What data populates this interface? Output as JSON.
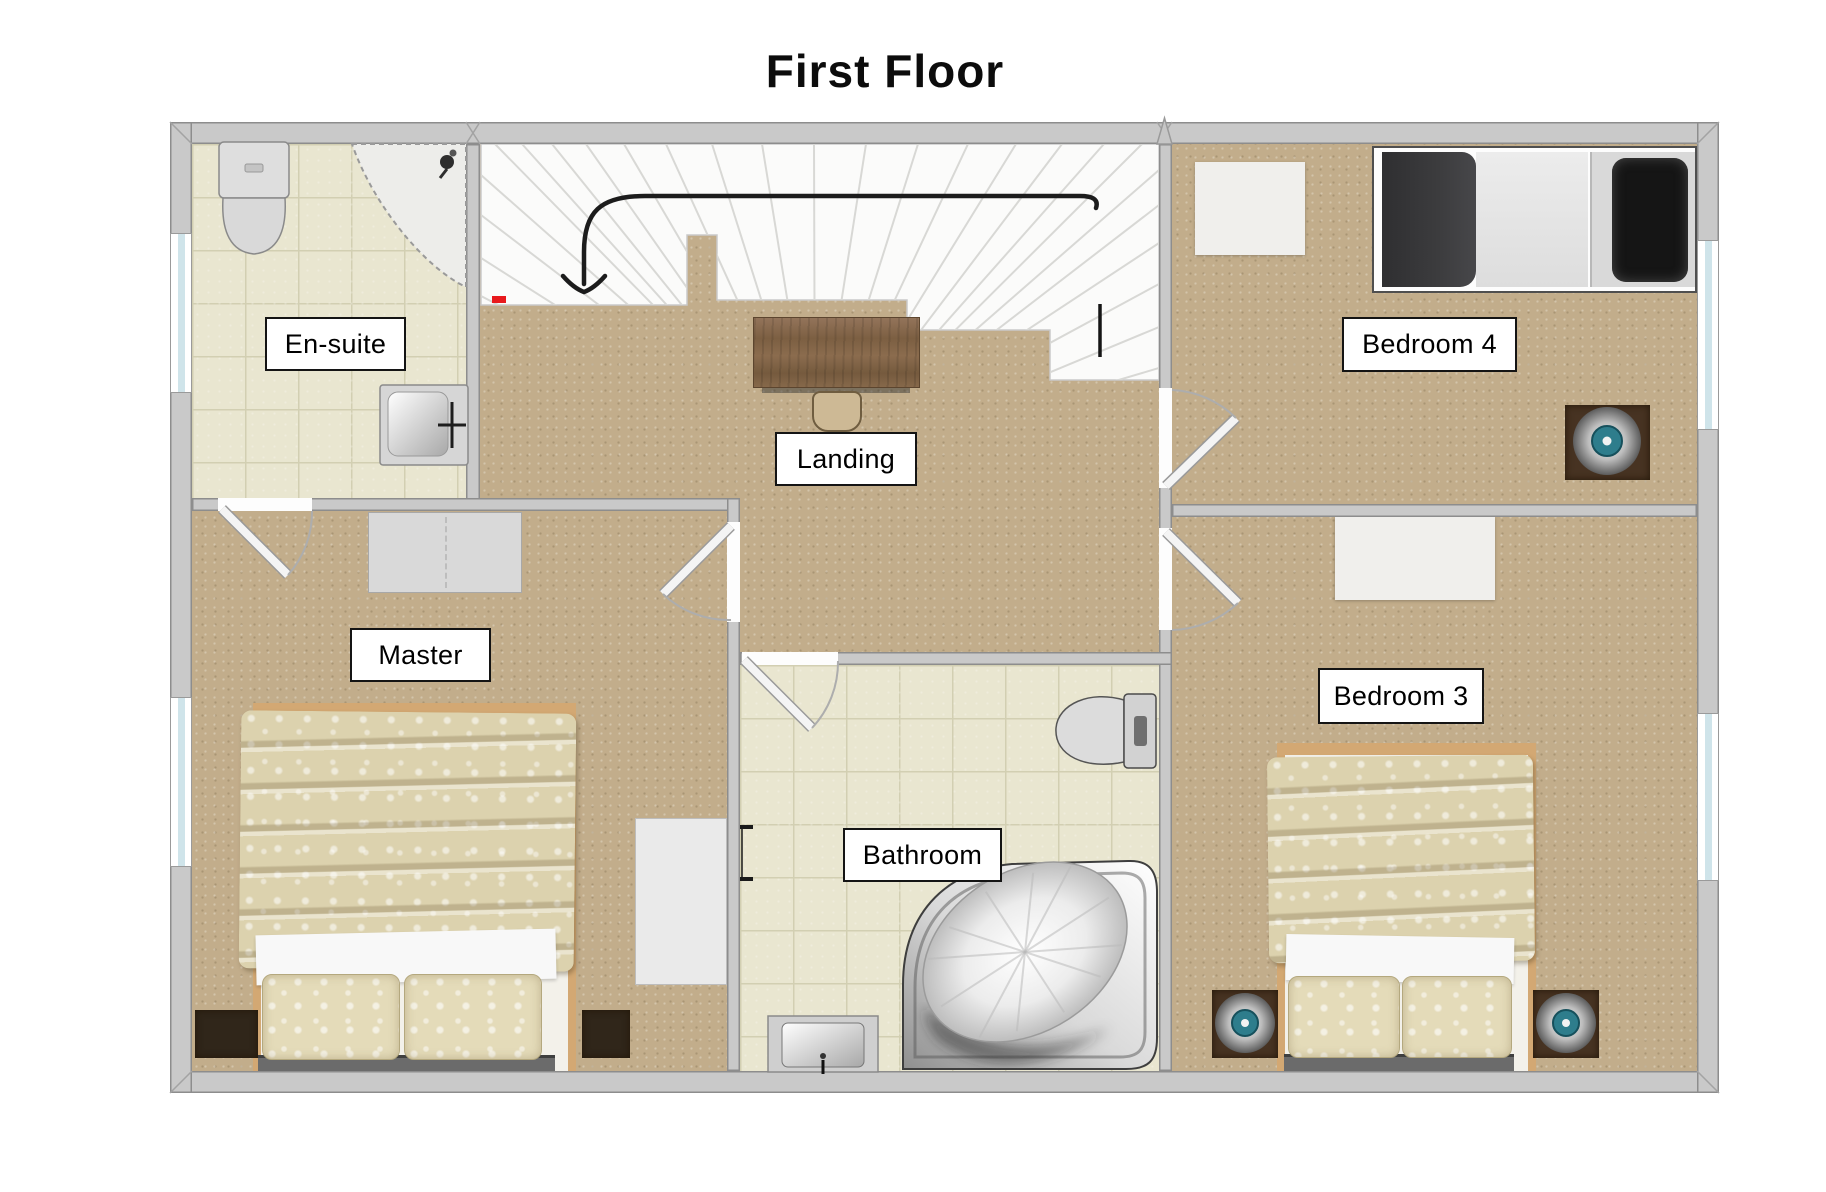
{
  "title": "First Floor",
  "rooms": {
    "ensuite": {
      "label": "En-suite"
    },
    "landing": {
      "label": "Landing"
    },
    "bedroom4": {
      "label": "Bedroom 4"
    },
    "master": {
      "label": "Master"
    },
    "bathroom": {
      "label": "Bathroom"
    },
    "bedroom3": {
      "label": "Bedroom 3"
    }
  },
  "icons": {
    "stairs_direction": "down-arrow-icon",
    "shower_head": "shower-head-icon"
  },
  "colors": {
    "carpet": "#c2ad8b",
    "tile": "#e9e6d0",
    "wall": "#c9c9c9",
    "wall_outline": "#8d8d8d",
    "stairs": "#fbfbfa",
    "label_border": "#141414",
    "duvet": "#dcd2ae",
    "bed_frame_tan": "#d3a873",
    "dark_duvet": "#3c3c3e",
    "nightstand": "#473322",
    "lamp_teal": "#2e7d8c",
    "desk_wood": "#8a6b4c",
    "arrow": "#1c1c1c",
    "marker_red": "#e8191c",
    "window_glass": "#cfe4ea"
  }
}
